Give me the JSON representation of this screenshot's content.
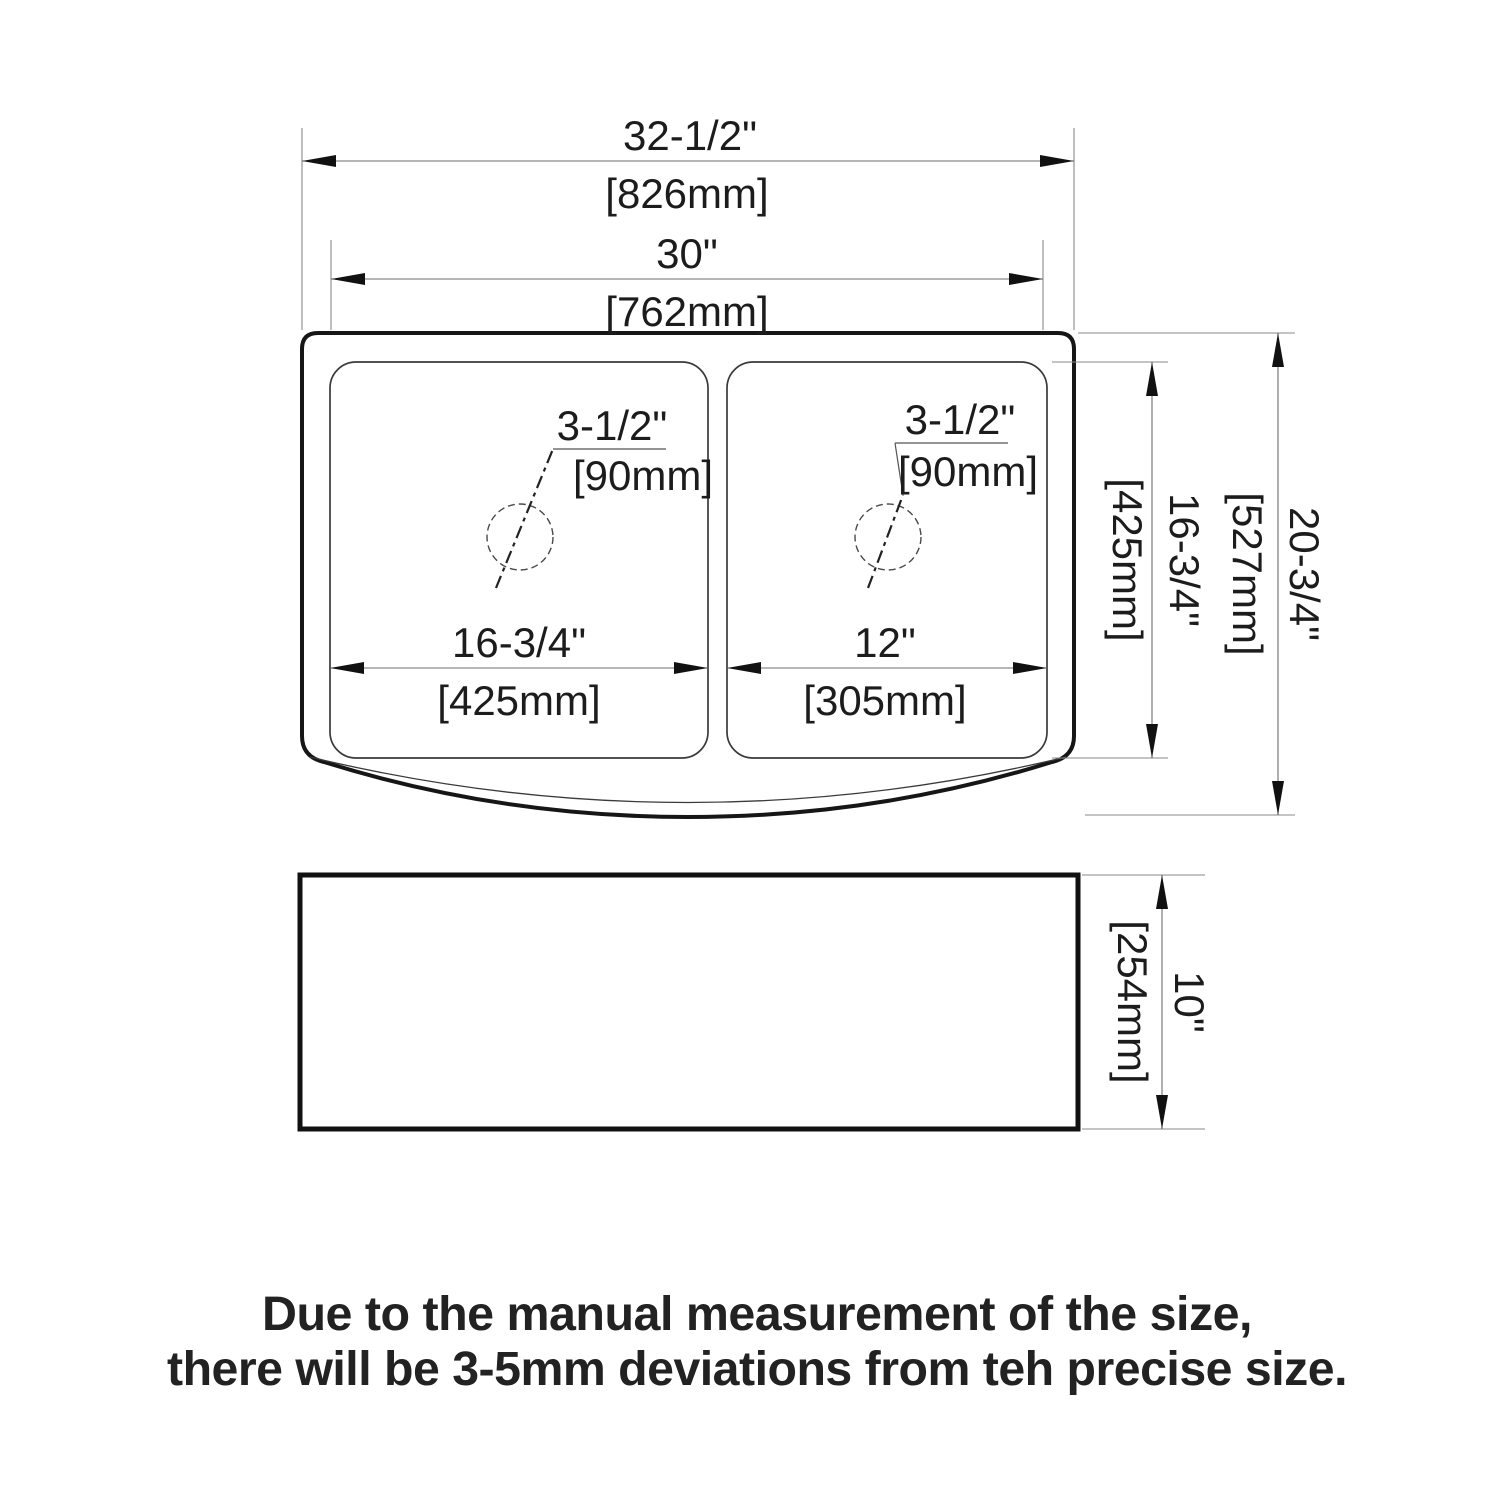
{
  "top_view": {
    "overall_width_in": "32-1/2\"",
    "overall_width_mm": "[826mm]",
    "opening_width_in": "30\"",
    "opening_width_mm": "[762mm]",
    "left_bowl_width_in": "16-3/4\"",
    "left_bowl_width_mm": "[425mm]",
    "right_bowl_width_in": "12\"",
    "right_bowl_width_mm": "[305mm]",
    "bowl_depth_in": "16-3/4\"",
    "bowl_depth_mm": "[425mm]",
    "overall_depth_in": "20-3/4\"",
    "overall_depth_mm": "[527mm]",
    "left_drain_in": "3-1/2\"",
    "left_drain_mm": "[90mm]",
    "right_drain_in": "3-1/2\"",
    "right_drain_mm": "[90mm]"
  },
  "side_view": {
    "height_in": "10\"",
    "height_mm": "[254mm]"
  },
  "disclaimer": {
    "line1": "Due to the manual measurement of the size,",
    "line2": "there will be 3-5mm deviations from teh precise size."
  }
}
